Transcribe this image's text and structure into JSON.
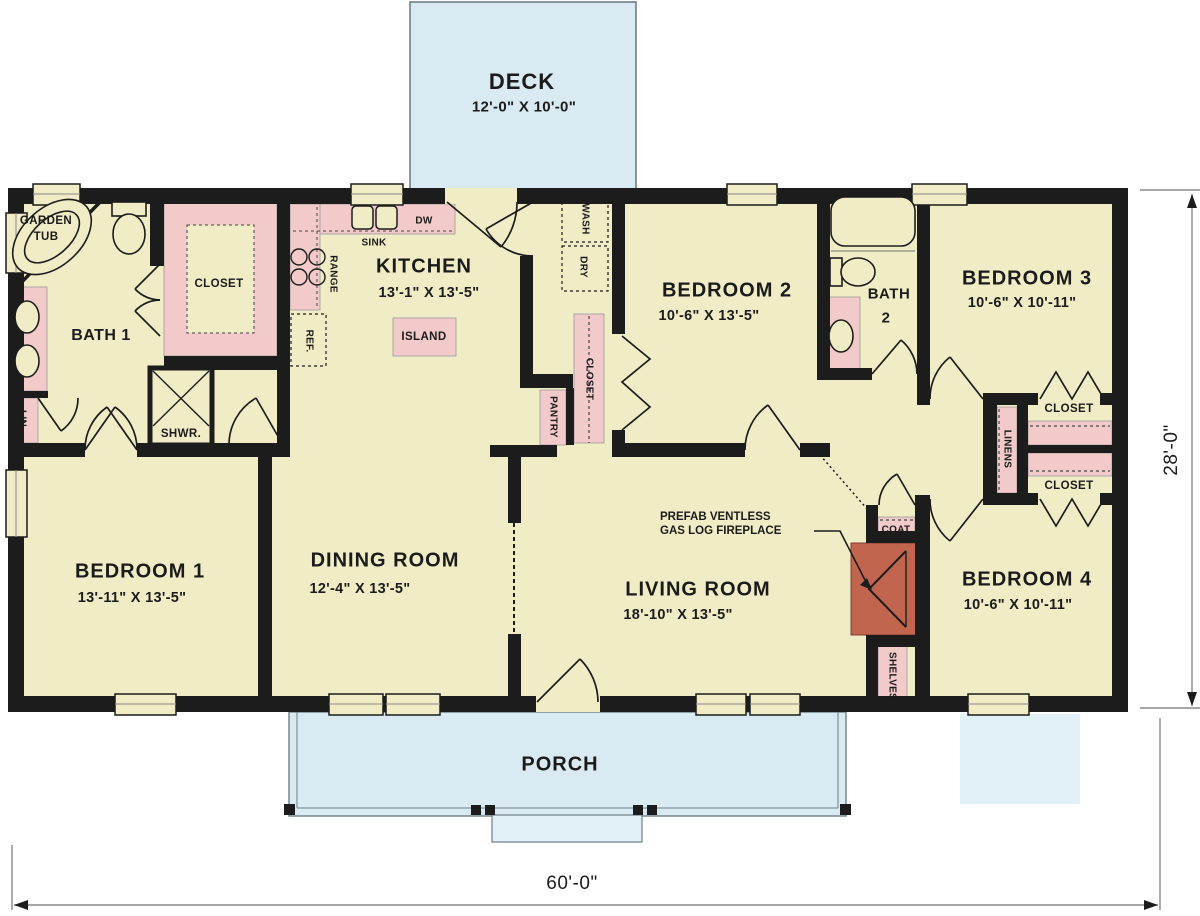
{
  "plan_title": "Ranch house first floor plan",
  "dimensions": {
    "overall_width": "60'-0\"",
    "overall_depth": "28'-0\""
  },
  "deck": {
    "label": "DECK",
    "dims": "12'-0\" X 10'-0\""
  },
  "porch": {
    "label": "PORCH"
  },
  "rooms": {
    "bedroom1": {
      "label": "BEDROOM 1",
      "dims": "13'-11\" X 13'-5\""
    },
    "bedroom2": {
      "label": "BEDROOM 2",
      "dims": "10'-6\" X 13'-5\""
    },
    "bedroom3": {
      "label": "BEDROOM 3",
      "dims": "10'-6\" X 10'-11\""
    },
    "bedroom4": {
      "label": "BEDROOM 4",
      "dims": "10'-6\" X 10'-11\""
    },
    "kitchen": {
      "label": "KITCHEN",
      "dims": "13'-1\" X 13'-5\""
    },
    "dining": {
      "label": "DINING ROOM",
      "dims": "12'-4\" X 13'-5\""
    },
    "living": {
      "label": "LIVING ROOM",
      "dims": "18'-10\" X 13'-5\""
    },
    "bath1": {
      "label": "BATH 1"
    },
    "bath2": {
      "label": "BATH",
      "number": "2"
    }
  },
  "features": {
    "garden_tub_line1": "GARDEN",
    "garden_tub_line2": "TUB",
    "closet_bath1": "CLOSET",
    "linen_cabinet": "LIN.",
    "shower": "SHWR.",
    "sink": "SINK",
    "dishwasher": "DW",
    "range": "RANGE",
    "refrigerator": "REF.",
    "island": "ISLAND",
    "washer": "WASH",
    "dryer": "DRY",
    "pantry": "PANTRY",
    "closet_bed2": "CLOSET",
    "closet_bed3": "CLOSET",
    "linens": "LINENS",
    "closet_bed4": "CLOSET",
    "coat": "COAT",
    "shelves": "SHELVES"
  },
  "annotation": {
    "fireplace_line1": "PREFAB VENTLESS",
    "fireplace_line2": "GAS LOG FIREPLACE"
  },
  "colors": {
    "floor": "#F0ECC5",
    "fixture_pink": "#F3CACA",
    "outdoor_blue": "#D9EAF2",
    "fireplace_red": "#C1654E",
    "wall": "#1C1C1C"
  }
}
